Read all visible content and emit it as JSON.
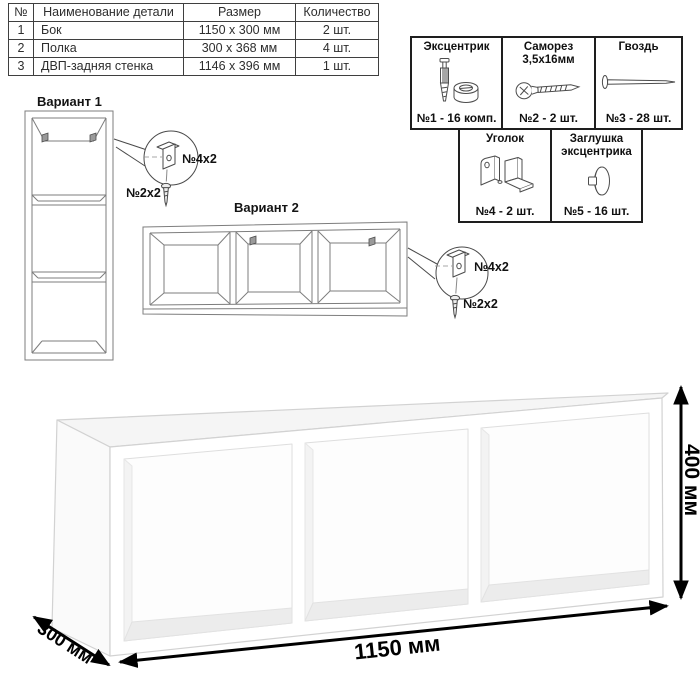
{
  "parts_table": {
    "headers": {
      "num": "№",
      "name": "Наименование детали",
      "size": "Размер",
      "qty": "Количество"
    },
    "rows": [
      {
        "num": "1",
        "name": "Бок",
        "size": "1150 x 300 мм",
        "qty": "2 шт."
      },
      {
        "num": "2",
        "name": "Полка",
        "size": "300 x 368 мм",
        "qty": "4 шт."
      },
      {
        "num": "3",
        "name": "ДВП-задняя стенка",
        "size": "1146 x 396 мм",
        "qty": "1 шт."
      }
    ]
  },
  "hardware_panel": {
    "items": [
      {
        "title": "Эксцентрик",
        "qty": "№1 - 16 комп.",
        "icon": "cam-bolt-icon"
      },
      {
        "title": "Саморез 3,5х16мм",
        "qty": "№2 - 2 шт.",
        "icon": "screw-icon"
      },
      {
        "title": "Гвоздь",
        "qty": "№3 - 28 шт.",
        "icon": "nail-icon"
      },
      {
        "title": "Уголок",
        "qty": "№4 - 2 шт.",
        "icon": "angle-bracket-icon"
      },
      {
        "title": "Заглушка эксцентрика",
        "qty": "№5 - 16 шт.",
        "icon": "cam-cap-icon"
      }
    ]
  },
  "variants": {
    "v1": {
      "title": "Вариант 1",
      "bracket_label": "№4x2",
      "screw_label": "№2x2"
    },
    "v2": {
      "title": "Вариант 2",
      "bracket_label": "№4x2",
      "screw_label": "№2x2"
    }
  },
  "dimensions": {
    "width": "1150 мм",
    "height": "400 мм",
    "depth": "300 мм"
  },
  "colors": {
    "dimension_arrows": "#000000",
    "wireframe_line": "#7d7d7d",
    "callout_line": "#4a4a4a",
    "shelf_edge": "#d2d2d2",
    "table_border": "#3f3f3f",
    "panel_border": "#1e1e1e"
  }
}
